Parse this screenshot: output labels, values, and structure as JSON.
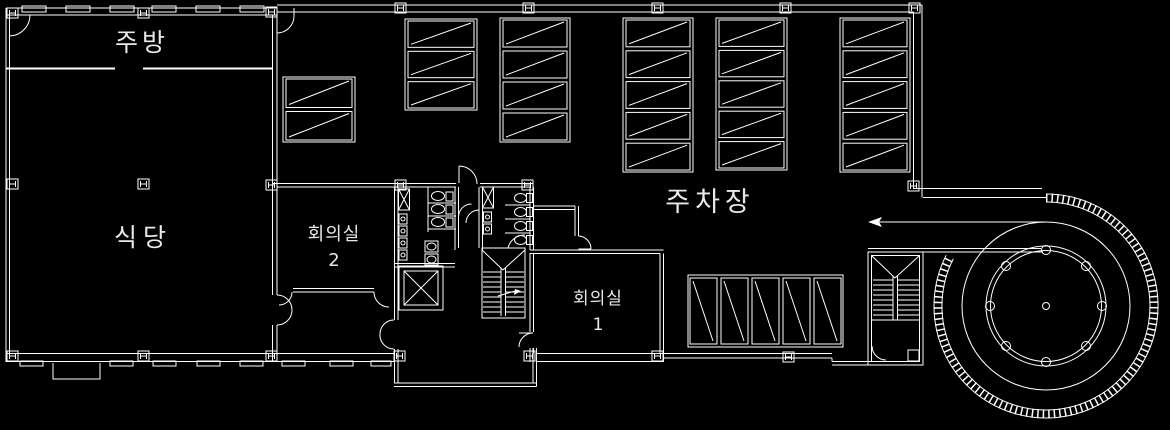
{
  "drawing": {
    "type": "floor-plan",
    "colors": {
      "background": "#000000",
      "line": "#ffffff",
      "text": "#e8e8e8"
    }
  },
  "rooms": {
    "kitchen": {
      "label": "주방"
    },
    "dining": {
      "label": "식당"
    },
    "meeting_room_2": {
      "label": "회의실",
      "number": "2"
    },
    "meeting_room_1": {
      "label": "회의실",
      "number": "1"
    },
    "parking_lot": {
      "label": "주차장"
    }
  },
  "parking": {
    "stall_total": 29,
    "groups": [
      {
        "id": "top-1",
        "x": 283,
        "y": 77,
        "w": 72,
        "h": 65,
        "stalls": 2,
        "dir": "h"
      },
      {
        "id": "top-2",
        "x": 405,
        "y": 19,
        "w": 72,
        "h": 91,
        "stalls": 3,
        "dir": "h"
      },
      {
        "id": "top-3",
        "x": 500,
        "y": 18,
        "w": 70,
        "h": 124,
        "stalls": 4,
        "dir": "h"
      },
      {
        "id": "top-4",
        "x": 623,
        "y": 18,
        "w": 70,
        "h": 154,
        "stalls": 5,
        "dir": "h"
      },
      {
        "id": "top-5",
        "x": 716,
        "y": 18,
        "w": 71,
        "h": 152,
        "stalls": 5,
        "dir": "h"
      },
      {
        "id": "top-6",
        "x": 840,
        "y": 18,
        "w": 70,
        "h": 154,
        "stalls": 5,
        "dir": "h"
      },
      {
        "id": "bottom-row",
        "x": 688,
        "y": 275,
        "w": 155,
        "h": 72,
        "stalls": 5,
        "dir": "v"
      }
    ]
  },
  "spiral_ramp": {
    "column_count": 8
  }
}
